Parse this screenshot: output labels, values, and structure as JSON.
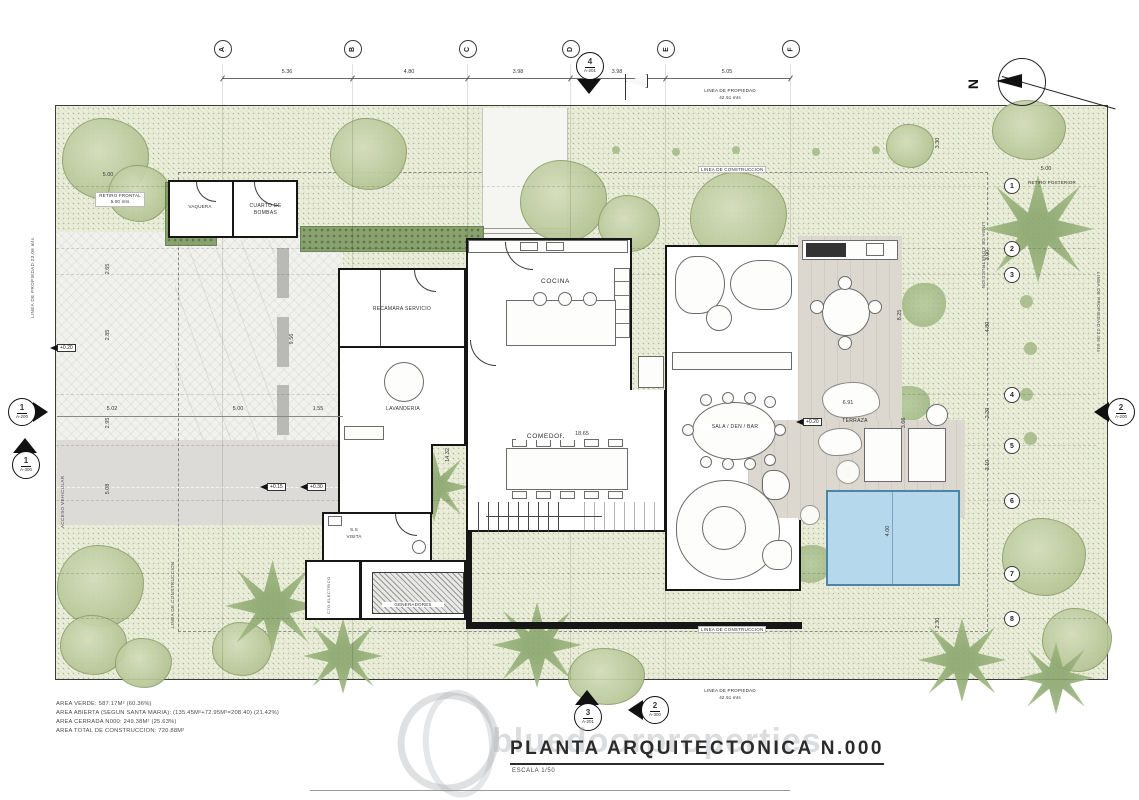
{
  "drawing": {
    "title": "PLANTA ARQUITECTONICA N.000",
    "scale_note": "ESCALA 1/50",
    "watermark": "bluedoorproperties",
    "north_label": "N"
  },
  "area_summary": {
    "line1": "AREA VERDE: 587.17M² (60.36%)",
    "line2": "AREA ABIERTA (SEGUN SANTA MARIA): (135.45M²+72.95M²=208.40) (21.42%)",
    "line3": "AREA CERRADA N000: 249.38M² (25.63%)",
    "line4": "AREA TOTAL DE CONSTRUCCION: 720.88M²"
  },
  "grid": {
    "cols": [
      "A",
      "B",
      "C",
      "D",
      "E",
      "F"
    ],
    "rows": [
      "1",
      "2",
      "3",
      "4",
      "5",
      "6",
      "7",
      "8"
    ]
  },
  "dims": {
    "top": [
      "5.36",
      "4.80",
      "3.98",
      "3.98",
      "5.05"
    ],
    "left_outer": [
      "2.65",
      "2.85",
      "2.95",
      "5.08"
    ],
    "mid_h": [
      "5.02",
      "5.00",
      "1.55"
    ],
    "carport_v": "9.56",
    "comedor_w": "18.65",
    "hall_v": "14.32",
    "terraza_rock": "6.91",
    "deck_v": "8.25",
    "lounger_v": "3.66",
    "pool_v": "4.00",
    "right_top_v": "3.30",
    "right_chain": [
      "3.00",
      "4.80",
      "2.20",
      "3.10",
      "2.30"
    ],
    "retiro_post": "5.00",
    "retiro_front": "5.00"
  },
  "rooms": {
    "vaquera": "VAQUERA",
    "cuarto_bombas": "CUARTO DE BOMBAS",
    "recamara_servicio": "RECAMARA SERVICIO",
    "cocina": "COCINA",
    "lavanderia": "LAVANDERIA",
    "comedor": "COMEDOR",
    "sala": "SALA / DEN / BAR",
    "terraza": "TERRAZA",
    "ss": "S.S",
    "visita": "VISITA",
    "cto_electrico": "CTO ELECTRICO",
    "generadores": "GENERADORES"
  },
  "site": {
    "linea_propiedad": "LINEA DE PROPIEDAD",
    "len_42": "42.51 mts",
    "len_23": "23.06 mts",
    "linea_construccion": "LINEA DE CONSTRUCCION",
    "retiro_frontal": "RETIRO FRONTAL",
    "retiro_frontal_len": "5.00 mts",
    "retiro_posterior": "RETIRO POSTERIOR",
    "acceso_vehicular": "ACCESO VEHICULAR"
  },
  "markers": {
    "top": {
      "num": "4",
      "sheet": "A-201"
    },
    "left_a200": {
      "num": "1",
      "sheet": "A-200"
    },
    "left_a300": {
      "num": "1",
      "sheet": "A-300"
    },
    "right_a200": {
      "num": "2",
      "sheet": "A-200"
    },
    "bottom_a201": {
      "num": "3",
      "sheet": "A-201"
    },
    "bottom_a300": {
      "num": "2",
      "sheet": "A-300"
    }
  },
  "elevations": {
    "e1": "+0.20",
    "e2": "+0.15",
    "e3": "+0.30",
    "e4": "+0.20"
  },
  "colors": {
    "site_green": "#ebeeda",
    "tree_green": "#bcca9c",
    "pool_blue": "#b5d8ec",
    "deck_gray": "#dcd8d0",
    "wall_black": "#161616"
  }
}
